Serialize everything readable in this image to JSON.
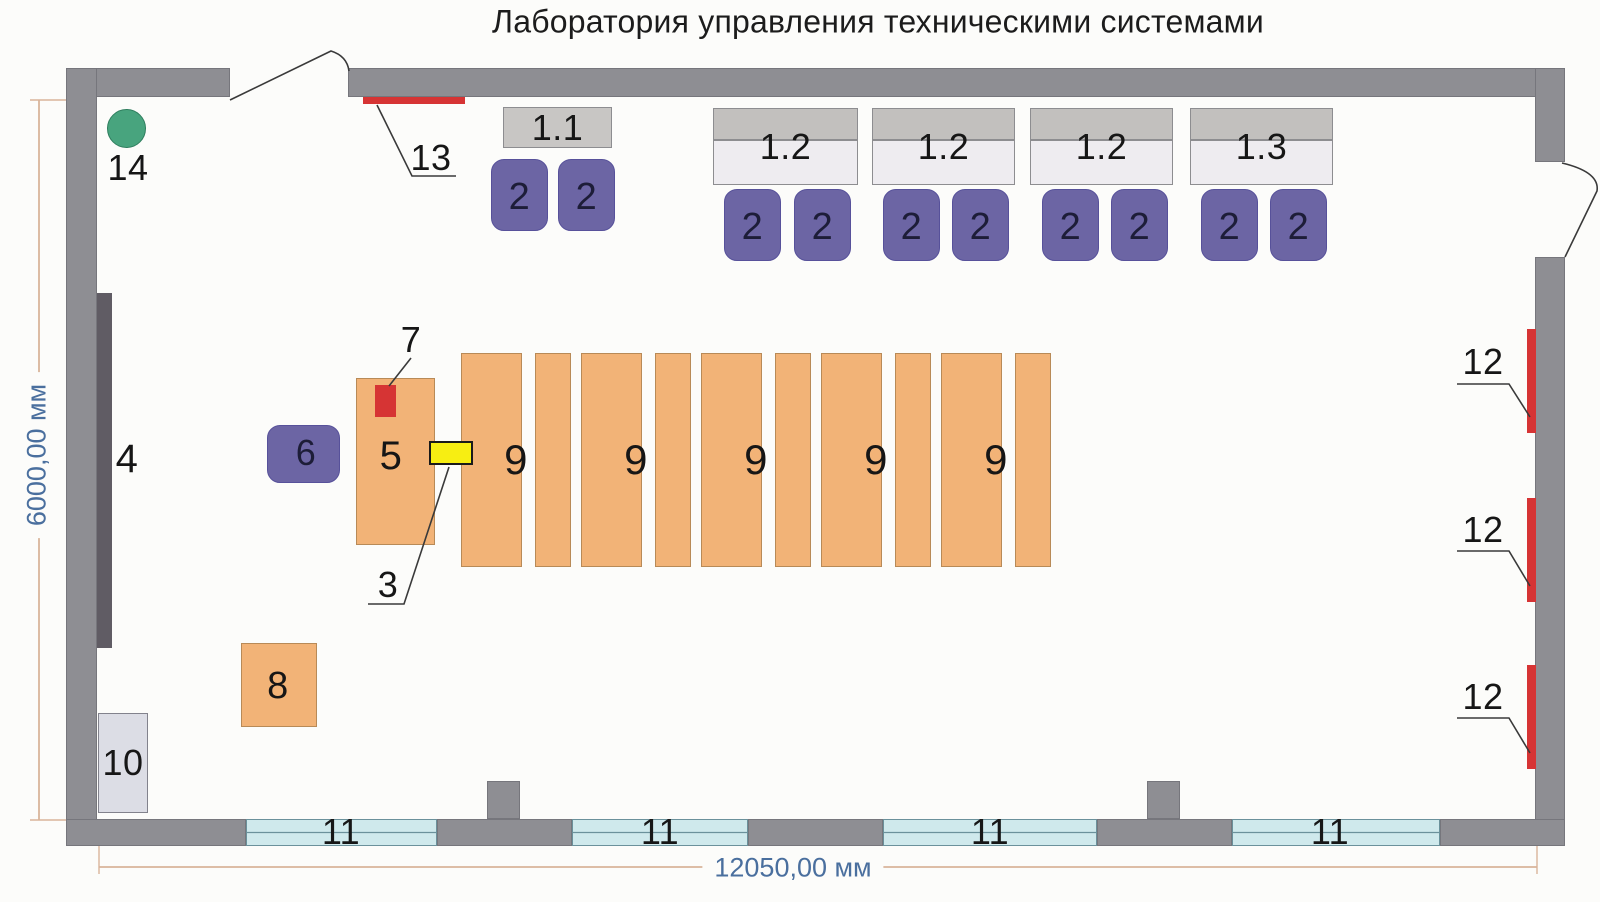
{
  "title": "Лаборатория управления техническими системами",
  "dimensions": {
    "width_label": "12050,00 мм",
    "height_label": "6000,00 мм"
  },
  "colors": {
    "bg": "#fcfcfa",
    "wall": "#8e8e93",
    "wall_edge": "#76767c",
    "board": "#605c64",
    "chair": "#6c65a4",
    "chair_edge": "#57519a",
    "num_on_purple": "#1d1d38",
    "table": "#f2b377",
    "table_edge": "#b88a57",
    "desk_single": "#c8c6c4",
    "desk_top": "#c2c0be",
    "desk_bottom": "#eeecf0",
    "desk_edge": "#8d8d90",
    "window": "#cfe9ec",
    "window_edge": "#6b919b",
    "red": "#d63434",
    "yellow": "#f7ee12",
    "yellow_edge": "#1a1a1a",
    "green": "#48a47e",
    "green_edge": "#2f7e5e",
    "cabinet": "#dcdde5",
    "cabinet_edge": "#82828c",
    "label": "#161616",
    "leader": "#3a3a3a",
    "dim_line": "#d9b49a",
    "dim_text": "#4a6f9e"
  },
  "walls": [
    {
      "name": "wall-top-left",
      "x": 66,
      "y": 68,
      "w": 164,
      "h": 29
    },
    {
      "name": "wall-top-right",
      "x": 348,
      "y": 68,
      "w": 1217,
      "h": 29
    },
    {
      "name": "wall-left",
      "x": 66,
      "y": 68,
      "w": 31,
      "h": 778
    },
    {
      "name": "wall-right-upper",
      "x": 1535,
      "y": 68,
      "w": 30,
      "h": 94
    },
    {
      "name": "wall-right-lower",
      "x": 1535,
      "y": 257,
      "w": 30,
      "h": 589
    },
    {
      "name": "wall-bottom-1",
      "x": 66,
      "y": 819,
      "w": 180,
      "h": 27
    },
    {
      "name": "wall-bottom-2",
      "x": 437,
      "y": 819,
      "w": 135,
      "h": 27
    },
    {
      "name": "wall-bottom-3",
      "x": 748,
      "y": 819,
      "w": 135,
      "h": 27
    },
    {
      "name": "wall-bottom-4",
      "x": 1097,
      "y": 819,
      "w": 135,
      "h": 27
    },
    {
      "name": "wall-bottom-5",
      "x": 1440,
      "y": 819,
      "w": 125,
      "h": 27
    },
    {
      "name": "pillar-1",
      "x": 487,
      "y": 781,
      "w": 33,
      "h": 38
    },
    {
      "name": "pillar-2",
      "x": 1147,
      "y": 781,
      "w": 33,
      "h": 38
    }
  ],
  "windows": {
    "label": "11",
    "y": 819,
    "h": 27,
    "items": [
      {
        "x": 246,
        "w": 191,
        "label_cx": 341
      },
      {
        "x": 572,
        "w": 176,
        "label_cx": 660
      },
      {
        "x": 883,
        "w": 214,
        "label_cx": 990
      },
      {
        "x": 1232,
        "w": 208,
        "label_cx": 1330
      }
    ]
  },
  "desks": [
    {
      "label": "1.1",
      "x": 503,
      "y": 107,
      "w": 109,
      "h": 41,
      "split": false
    },
    {
      "label": "1.2",
      "x": 713,
      "y": 108,
      "w": 145,
      "h": 77,
      "split": true,
      "top_h": 32
    },
    {
      "label": "1.2",
      "x": 872,
      "y": 108,
      "w": 143,
      "h": 77,
      "split": true,
      "top_h": 32
    },
    {
      "label": "1.2",
      "x": 1030,
      "y": 108,
      "w": 143,
      "h": 77,
      "split": true,
      "top_h": 32
    },
    {
      "label": "1.3",
      "x": 1190,
      "y": 108,
      "w": 143,
      "h": 77,
      "split": true,
      "top_h": 32
    }
  ],
  "chairs": {
    "label": "2",
    "w": 57,
    "h": 72,
    "items": [
      {
        "x": 491,
        "y": 159
      },
      {
        "x": 558,
        "y": 159
      },
      {
        "x": 724,
        "y": 189
      },
      {
        "x": 794,
        "y": 189
      },
      {
        "x": 883,
        "y": 189
      },
      {
        "x": 952,
        "y": 189
      },
      {
        "x": 1042,
        "y": 189
      },
      {
        "x": 1111,
        "y": 189
      },
      {
        "x": 1201,
        "y": 189
      },
      {
        "x": 1270,
        "y": 189
      }
    ]
  },
  "lab_tables": {
    "label": "9",
    "y": 353,
    "h": 214,
    "wide_w": 61,
    "gap": 13,
    "narrow_w": 36,
    "items_x": [
      461,
      581,
      701,
      821,
      941
    ]
  },
  "equipment": [
    {
      "name": "demo-table-5",
      "label": "5",
      "x": 356,
      "y": 378,
      "w": 79,
      "h": 167,
      "fill": "table",
      "edge": "table_edge",
      "label_cx": 391,
      "label_cy": 456,
      "label_size": 40
    },
    {
      "name": "bench-8",
      "label": "8",
      "x": 241,
      "y": 643,
      "w": 76,
      "h": 84,
      "fill": "table",
      "edge": "table_edge",
      "label_cx": 278,
      "label_cy": 686,
      "label_size": 38
    },
    {
      "name": "cabinet-10",
      "label": "10",
      "x": 98,
      "y": 713,
      "w": 50,
      "h": 100,
      "fill": "cabinet",
      "edge": "cabinet_edge",
      "label_cx": 123,
      "label_cy": 763,
      "label_size": 36
    },
    {
      "name": "instructor-chair-6",
      "label": "6",
      "x": 267,
      "y": 425,
      "w": 73,
      "h": 58,
      "fill": "chair",
      "edge": "chair_edge",
      "r": 13,
      "label_cx": 306,
      "label_cy": 453,
      "label_size": 36,
      "label_color": "num_on_purple"
    },
    {
      "name": "board-4",
      "x": 97,
      "y": 293,
      "w": 15,
      "h": 355,
      "fill": "board"
    },
    {
      "name": "device-7",
      "x": 375,
      "y": 385,
      "w": 21,
      "h": 32,
      "fill": "red"
    },
    {
      "name": "switch-3",
      "x": 429,
      "y": 441,
      "w": 44,
      "h": 24,
      "fill": "yellow",
      "border": "2px solid #1a1a1a"
    },
    {
      "name": "heater-strip-13",
      "x": 363,
      "y": 97,
      "w": 102,
      "h": 7,
      "fill": "red"
    },
    {
      "name": "marker-14",
      "x": 107,
      "y": 109,
      "w": 39,
      "h": 39,
      "fill": "green",
      "edge": "green_edge",
      "r": 20
    }
  ],
  "radiators": {
    "label": "12",
    "items": [
      {
        "x": 1527,
        "y": 329,
        "w": 9,
        "h": 104
      },
      {
        "x": 1527,
        "y": 498,
        "w": 9,
        "h": 104
      },
      {
        "x": 1527,
        "y": 665,
        "w": 9,
        "h": 104
      }
    ],
    "label_pos": [
      {
        "cx": 1483,
        "cy": 362
      },
      {
        "cx": 1483,
        "cy": 530
      },
      {
        "cx": 1483,
        "cy": 697
      }
    ]
  },
  "free_labels": [
    {
      "name": "label-4",
      "text": "4",
      "cx": 127,
      "cy": 459,
      "size": 40
    },
    {
      "name": "label-7",
      "text": "7",
      "cx": 411,
      "cy": 340,
      "size": 36
    },
    {
      "name": "label-3",
      "text": "3",
      "cx": 388,
      "cy": 585,
      "size": 36
    },
    {
      "name": "label-13",
      "text": "13",
      "cx": 431,
      "cy": 158,
      "size": 36
    },
    {
      "name": "label-14",
      "text": "14",
      "cx": 128,
      "cy": 168,
      "size": 36
    }
  ],
  "leaders": [
    {
      "name": "leader-13",
      "pts": [
        [
          377,
          105
        ],
        [
          412,
          176
        ],
        [
          456,
          176
        ]
      ]
    },
    {
      "name": "leader-7",
      "pts": [
        [
          411,
          358
        ],
        [
          389,
          386
        ]
      ]
    },
    {
      "name": "leader-3",
      "pts": [
        [
          368,
          604
        ],
        [
          404,
          604
        ],
        [
          449,
          467
        ]
      ]
    },
    {
      "name": "leader-12-1",
      "pts": [
        [
          1457,
          384
        ],
        [
          1509,
          384
        ],
        [
          1530,
          417
        ]
      ]
    },
    {
      "name": "leader-12-2",
      "pts": [
        [
          1457,
          551
        ],
        [
          1509,
          551
        ],
        [
          1530,
          586
        ]
      ]
    },
    {
      "name": "leader-12-3",
      "pts": [
        [
          1457,
          718
        ],
        [
          1509,
          718
        ],
        [
          1530,
          753
        ]
      ]
    }
  ],
  "doors": [
    {
      "name": "door-top",
      "d": "M 230 100 L 331 51 Q 347 56 349 71"
    },
    {
      "name": "door-right",
      "d": "M 1562 163 Q 1600 172 1597 191 L 1565 257"
    }
  ],
  "dim_h": {
    "line": [
      99,
      867,
      1537,
      867
    ],
    "ext": [
      [
        99,
        846,
        99,
        874
      ],
      [
        1537,
        846,
        1537,
        874
      ]
    ]
  },
  "dim_v": {
    "line": [
      39,
      100,
      39,
      820
    ],
    "ext": [
      [
        30,
        100,
        66,
        100
      ],
      [
        30,
        820,
        66,
        820
      ]
    ]
  }
}
